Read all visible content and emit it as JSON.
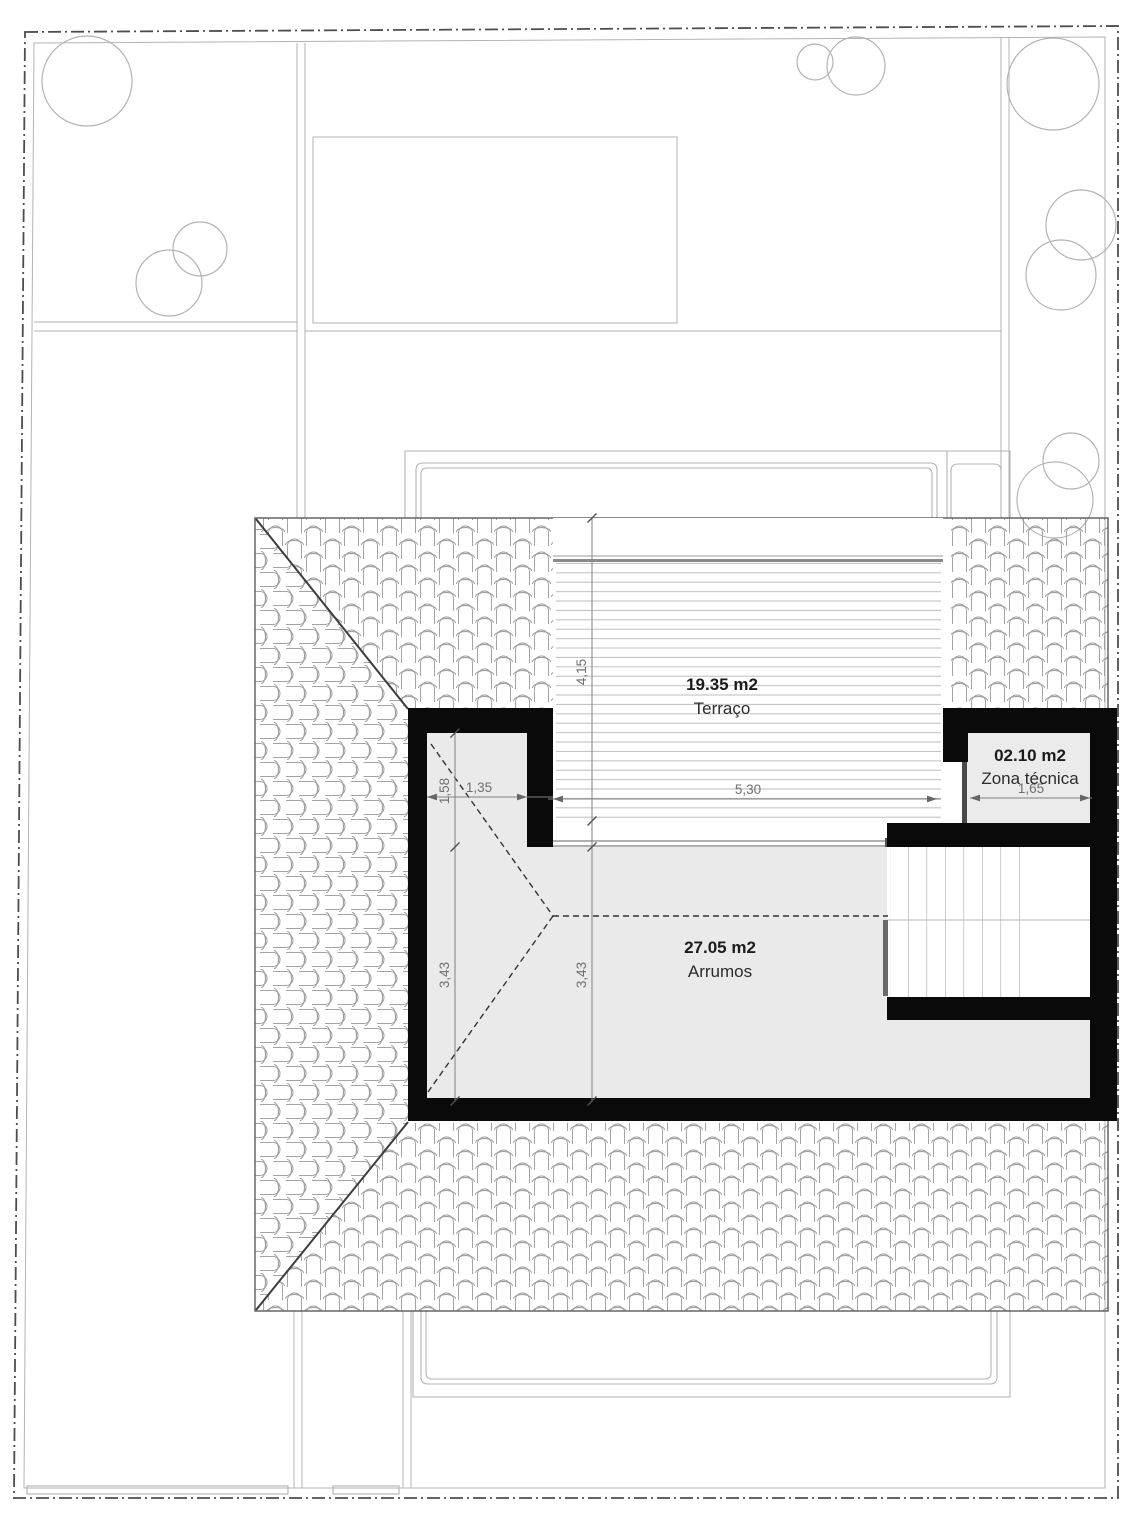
{
  "drawing": {
    "rooms": {
      "terraco": {
        "area": "19.35 m2",
        "name": "Terraço"
      },
      "zona_tecnica": {
        "area": "02.10 m2",
        "name": "Zona técnica"
      },
      "arrumos": {
        "area": "27.05 m2",
        "name": "Arrumos"
      }
    },
    "dimensions": {
      "terrace_depth": "4,15",
      "terrace_width": "5,30",
      "nook_width": "1,35",
      "nook_depth": "1,58",
      "zona_tecnica_width": "1,65",
      "arrumos_depth_left": "3,43",
      "arrumos_depth_mid": "3,43"
    },
    "colors": {
      "wall": "#0a0a0a",
      "room_fill": "#eaeaea",
      "tile_hatch_line": "#9a9a9a",
      "deck_line": "#bdbdbd",
      "dimension_line": "#808080",
      "dimension_text": "#6f6f6f",
      "boundary_line": "#4d4d4d",
      "garden_line": "#b3b3b3"
    }
  }
}
